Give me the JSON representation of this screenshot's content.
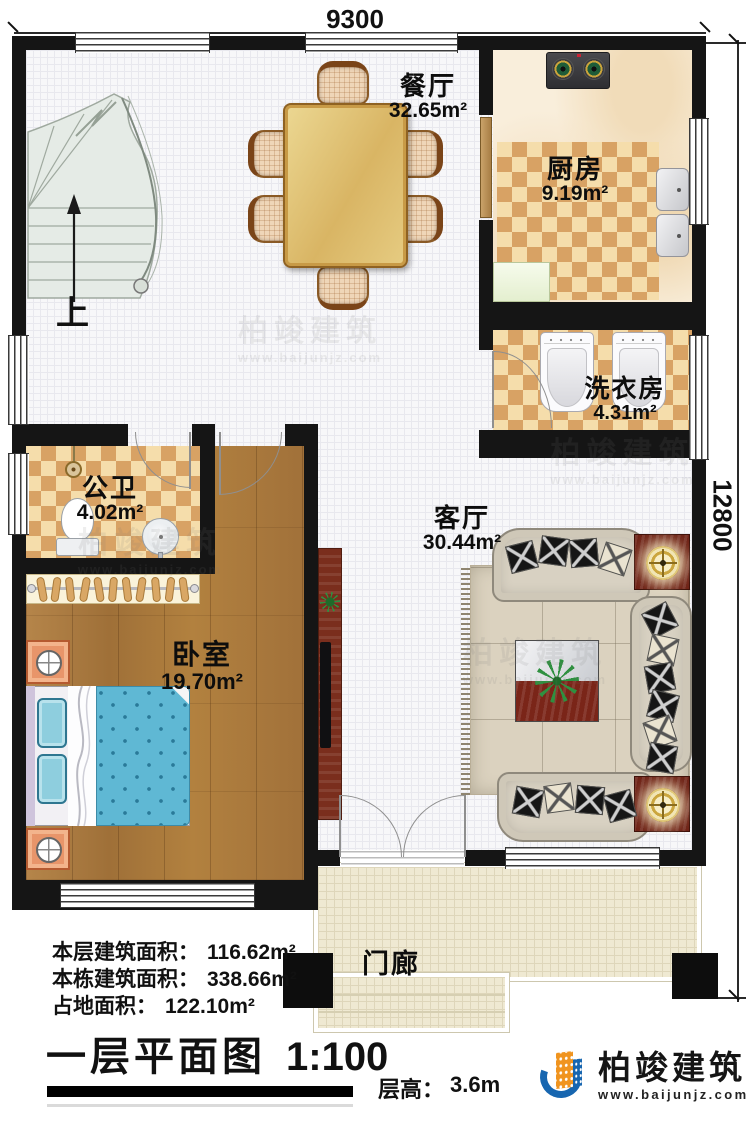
{
  "plan": {
    "title": "一层平面图",
    "scale": "1:100",
    "floor_height_label": "层高：",
    "floor_height_value": "3.6m"
  },
  "dimensions": {
    "width": "9300",
    "height": "12800"
  },
  "rooms": {
    "dining": {
      "name": "餐厅",
      "area": "32.65m²"
    },
    "kitchen": {
      "name": "厨房",
      "area": "9.19m²"
    },
    "laundry": {
      "name": "洗衣房",
      "area": "4.31m²"
    },
    "bathroom": {
      "name": "公卫",
      "area": "4.02m²"
    },
    "bedroom": {
      "name": "卧室",
      "area": "19.70m²"
    },
    "living": {
      "name": "客厅",
      "area": "30.44m²"
    },
    "porch": {
      "name": "门廊"
    }
  },
  "stairs": {
    "up_label": "上"
  },
  "area_summary": [
    {
      "label": "本层建筑面积：",
      "value": "116.62m²"
    },
    {
      "label": "本栋建筑面积：",
      "value": "338.66m²"
    },
    {
      "label": "占地面积：",
      "value": "122.10m²"
    }
  ],
  "branding": {
    "company": "柏竣建筑",
    "website": "www.baijunjz.com"
  },
  "colors": {
    "wall": "#151515",
    "checker_dark": "#d8a264",
    "checker_light": "#f5ddab",
    "wood": "#a9793e",
    "quilt_blue": "#5fb8d4",
    "porch_tile": "#efe9d2",
    "brand_blue": "#1766b0",
    "brand_orange": "#f0941f"
  }
}
